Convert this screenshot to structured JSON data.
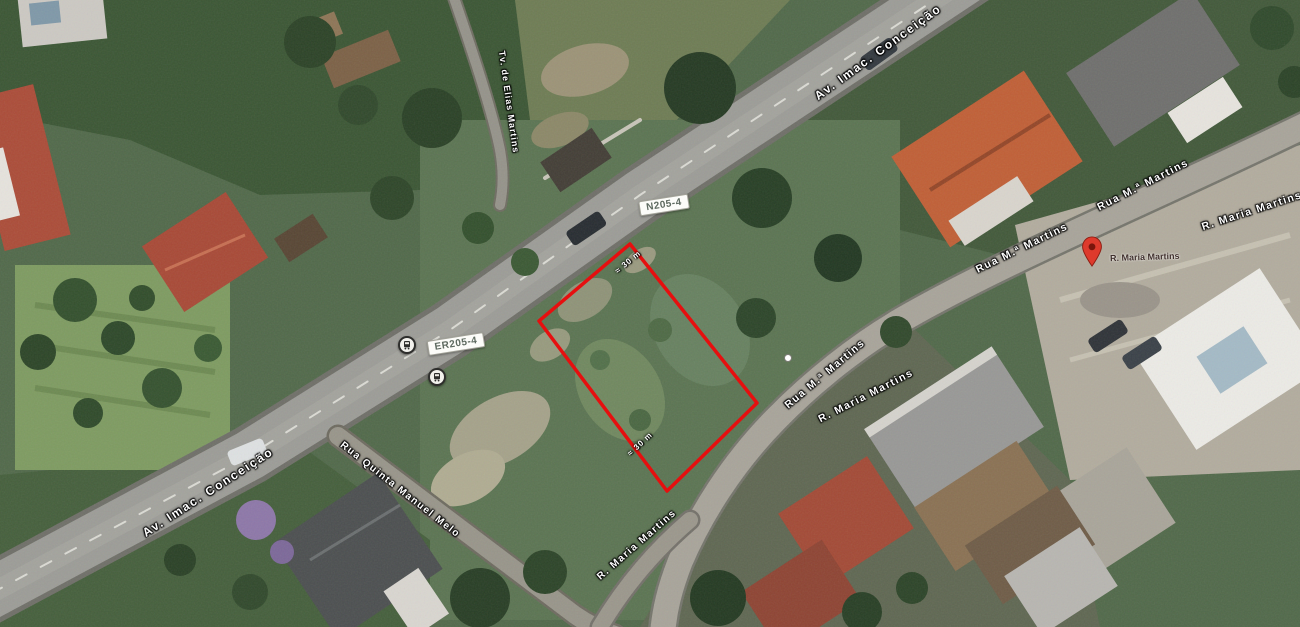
{
  "map": {
    "view": "Satellite aerial view with outlined land parcel",
    "route_shields": [
      {
        "label": "N205-4"
      },
      {
        "label": "ER205-4"
      }
    ],
    "road_labels": [
      {
        "text": "Av. Imac. Conceição"
      },
      {
        "text": "Av. Imac. Conceição"
      },
      {
        "text": "Rua M.ª Martins"
      },
      {
        "text": "Rua M.ª Martins"
      },
      {
        "text": "R. Maria Martins"
      },
      {
        "text": "Rua M.ª Martins"
      },
      {
        "text": "R. Maria Martins"
      },
      {
        "text": "R. Maria Martins"
      },
      {
        "text": "Tv. de Elias Martins"
      },
      {
        "text": "Rua Quinta Manuel Melo"
      }
    ],
    "place_pin": {
      "label": "R. Maria Martins",
      "color": "#de3a2c"
    },
    "parcel": {
      "outline_color": "#e60f0f",
      "measurements": [
        {
          "text": "≈ 30 m"
        },
        {
          "text": "≈ 30 m"
        }
      ]
    }
  }
}
